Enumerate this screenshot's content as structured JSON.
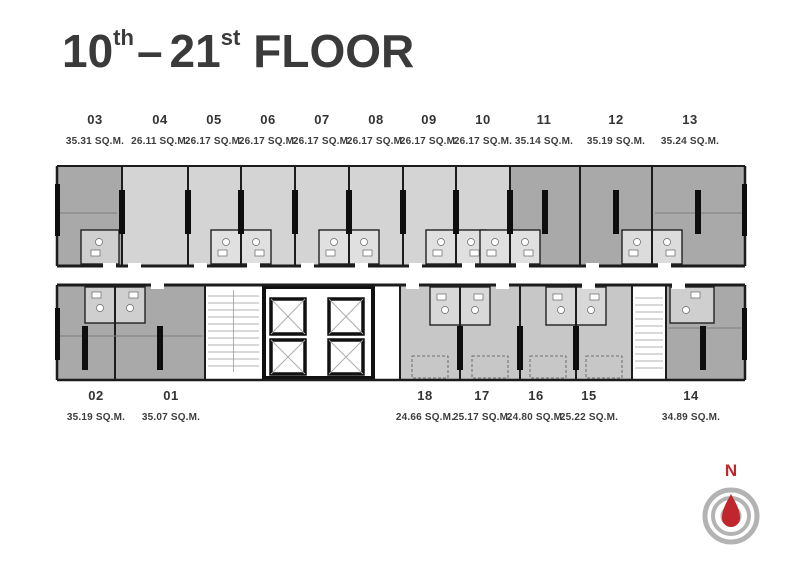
{
  "title": {
    "range_start": "10",
    "range_start_suffix": "th",
    "separator": "–",
    "range_end": "21",
    "range_end_suffix": "st",
    "label": "FLOOR"
  },
  "units": {
    "top": [
      {
        "number": "03",
        "area": "35.31 SQ.M."
      },
      {
        "number": "04",
        "area": "26.11 SQ.M."
      },
      {
        "number": "05",
        "area": "26.17 SQ.M."
      },
      {
        "number": "06",
        "area": "26.17 SQ.M."
      },
      {
        "number": "07",
        "area": "26.17 SQ.M."
      },
      {
        "number": "08",
        "area": "26.17 SQ.M."
      },
      {
        "number": "09",
        "area": "26.17 SQ.M."
      },
      {
        "number": "10",
        "area": "26.17 SQ.M."
      },
      {
        "number": "11",
        "area": "35.14 SQ.M."
      },
      {
        "number": "12",
        "area": "35.19 SQ.M."
      },
      {
        "number": "13",
        "area": "35.24 SQ.M."
      }
    ],
    "bottom": [
      {
        "number": "02",
        "area": "35.19 SQ.M."
      },
      {
        "number": "01",
        "area": "35.07 SQ.M."
      },
      {
        "number": "18",
        "area": "24.66 SQ.M."
      },
      {
        "number": "17",
        "area": "25.17 SQ.M."
      },
      {
        "number": "16",
        "area": "24.80 SQ.M."
      },
      {
        "number": "15",
        "area": "25.22 SQ.M."
      },
      {
        "number": "14",
        "area": "34.89 SQ.M."
      }
    ]
  },
  "compass": {
    "north_label": "N"
  },
  "colors": {
    "accent_red": "#c0272d",
    "compass_ring": "#b3b3b3",
    "unit_dark": "#a9a9a9",
    "unit_light": "#d4d4d4",
    "unit_medium": "#c7c7c7",
    "bathroom_light": "#e0e0e0",
    "bathroom_dark": "#cfcfcf",
    "wall": "#1c1c1c",
    "title_text": "#3a3a3a"
  }
}
